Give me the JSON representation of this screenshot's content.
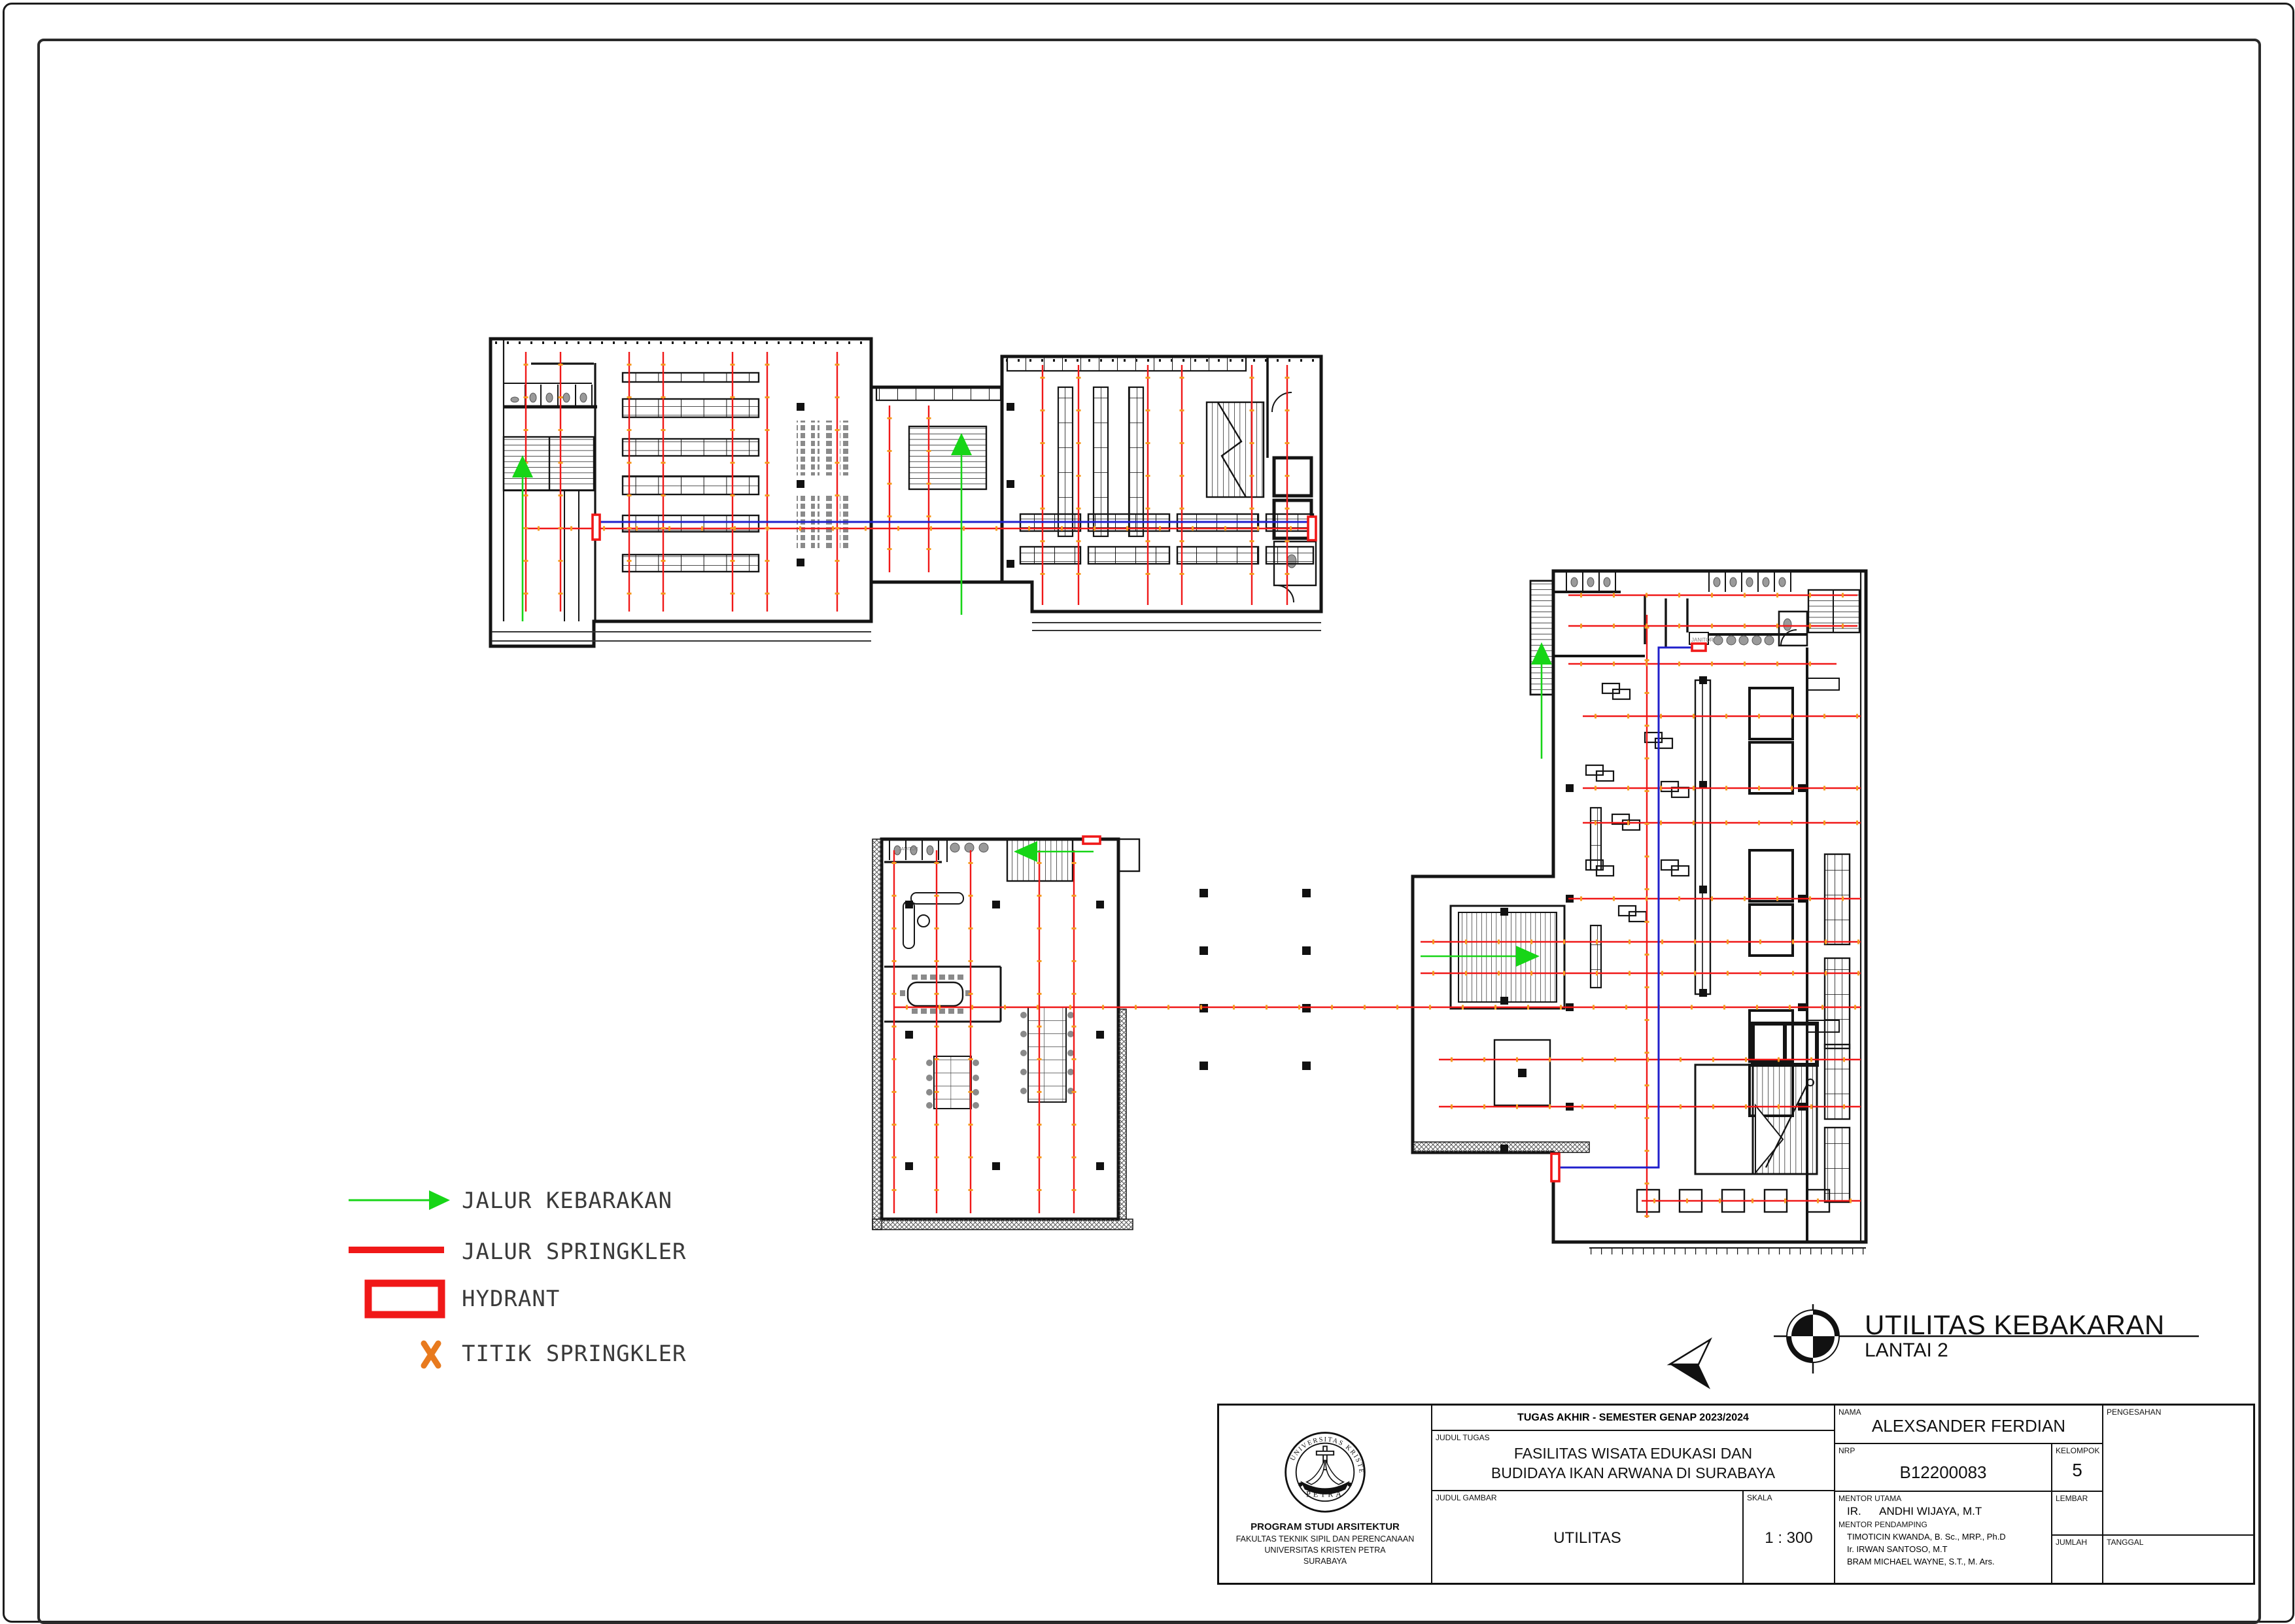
{
  "sheet": {
    "background": "#ffffff",
    "colors": {
      "wall": "#141414",
      "sprinkler_red": "#f01818",
      "sprinkler_tick_orange": "#f59b22",
      "fire_path_green": "#17d517",
      "utility_blue": "#2020cc",
      "furniture_gray": "#8a8a8a"
    }
  },
  "legend": {
    "items": [
      {
        "name": "jalur-kebakaran",
        "label": "JALUR KEBARAKAN",
        "symbol": "green-arrow",
        "color": "#17d517"
      },
      {
        "name": "jalur-springkler",
        "label": "JALUR SPRINGKLER",
        "symbol": "red-line",
        "color": "#f01818"
      },
      {
        "name": "hydrant",
        "label": "HYDRANT",
        "symbol": "red-rectangle",
        "color": "#f01818"
      },
      {
        "name": "titik-springkler",
        "label": "TITIK SPRINGKLER",
        "symbol": "orange-x",
        "color": "#e87a1e"
      }
    ]
  },
  "drawing_title": {
    "title": "UTILITAS KEBAKARAN",
    "subtitle": "LANTAI 2"
  },
  "rooms": {
    "janitor": "JANITOR"
  },
  "title_block": {
    "project_header": "TUGAS AKHIR - SEMESTER GENAP 2023/2024",
    "labels": {
      "judul_tugas": "JUDUL TUGAS",
      "judul_gambar": "JUDUL GAMBAR",
      "skala": "SKALA",
      "nama": "NAMA",
      "nrp": "NRP",
      "kelompok": "KELOMPOK",
      "mentor_utama": "MENTOR UTAMA",
      "mentor_pendamping": "MENTOR PENDAMPING",
      "pengesahan": "PENGESAHAN",
      "lembar": "LEMBAR",
      "jumlah": "JUMLAH",
      "tanggal": "TANGGAL"
    },
    "values": {
      "judul_tugas_line1": "FASILITAS WISATA EDUKASI DAN",
      "judul_tugas_line2": "BUDIDAYA IKAN ARWANA DI SURABAYA",
      "judul_gambar": "UTILITAS",
      "skala": "1 : 300",
      "nama": "ALEXSANDER FERDIAN",
      "nrp": "B12200083",
      "kelompok": "5",
      "mentor_utama": "IR.      ANDHI WIJAYA, M.T",
      "mentor_pendamping_1": "TIMOTICIN KWANDA, B. Sc., MRP., Ph.D",
      "mentor_pendamping_2": "Ir. IRWAN SANTOSO, M.T",
      "mentor_pendamping_3": "BRAM MICHAEL WAYNE, S.T., M. Ars."
    },
    "institution": {
      "program": "PROGRAM STUDI ARSITEKTUR",
      "fakultas": "FAKULTAS TEKNIK SIPIL DAN PERENCANAAN",
      "universitas": "UNIVERSITAS KRISTEN PETRA",
      "kota": "SURABAYA",
      "seal_ring": "UNIVERSITAS KRISTEN",
      "seal_name": "PETRA"
    }
  }
}
